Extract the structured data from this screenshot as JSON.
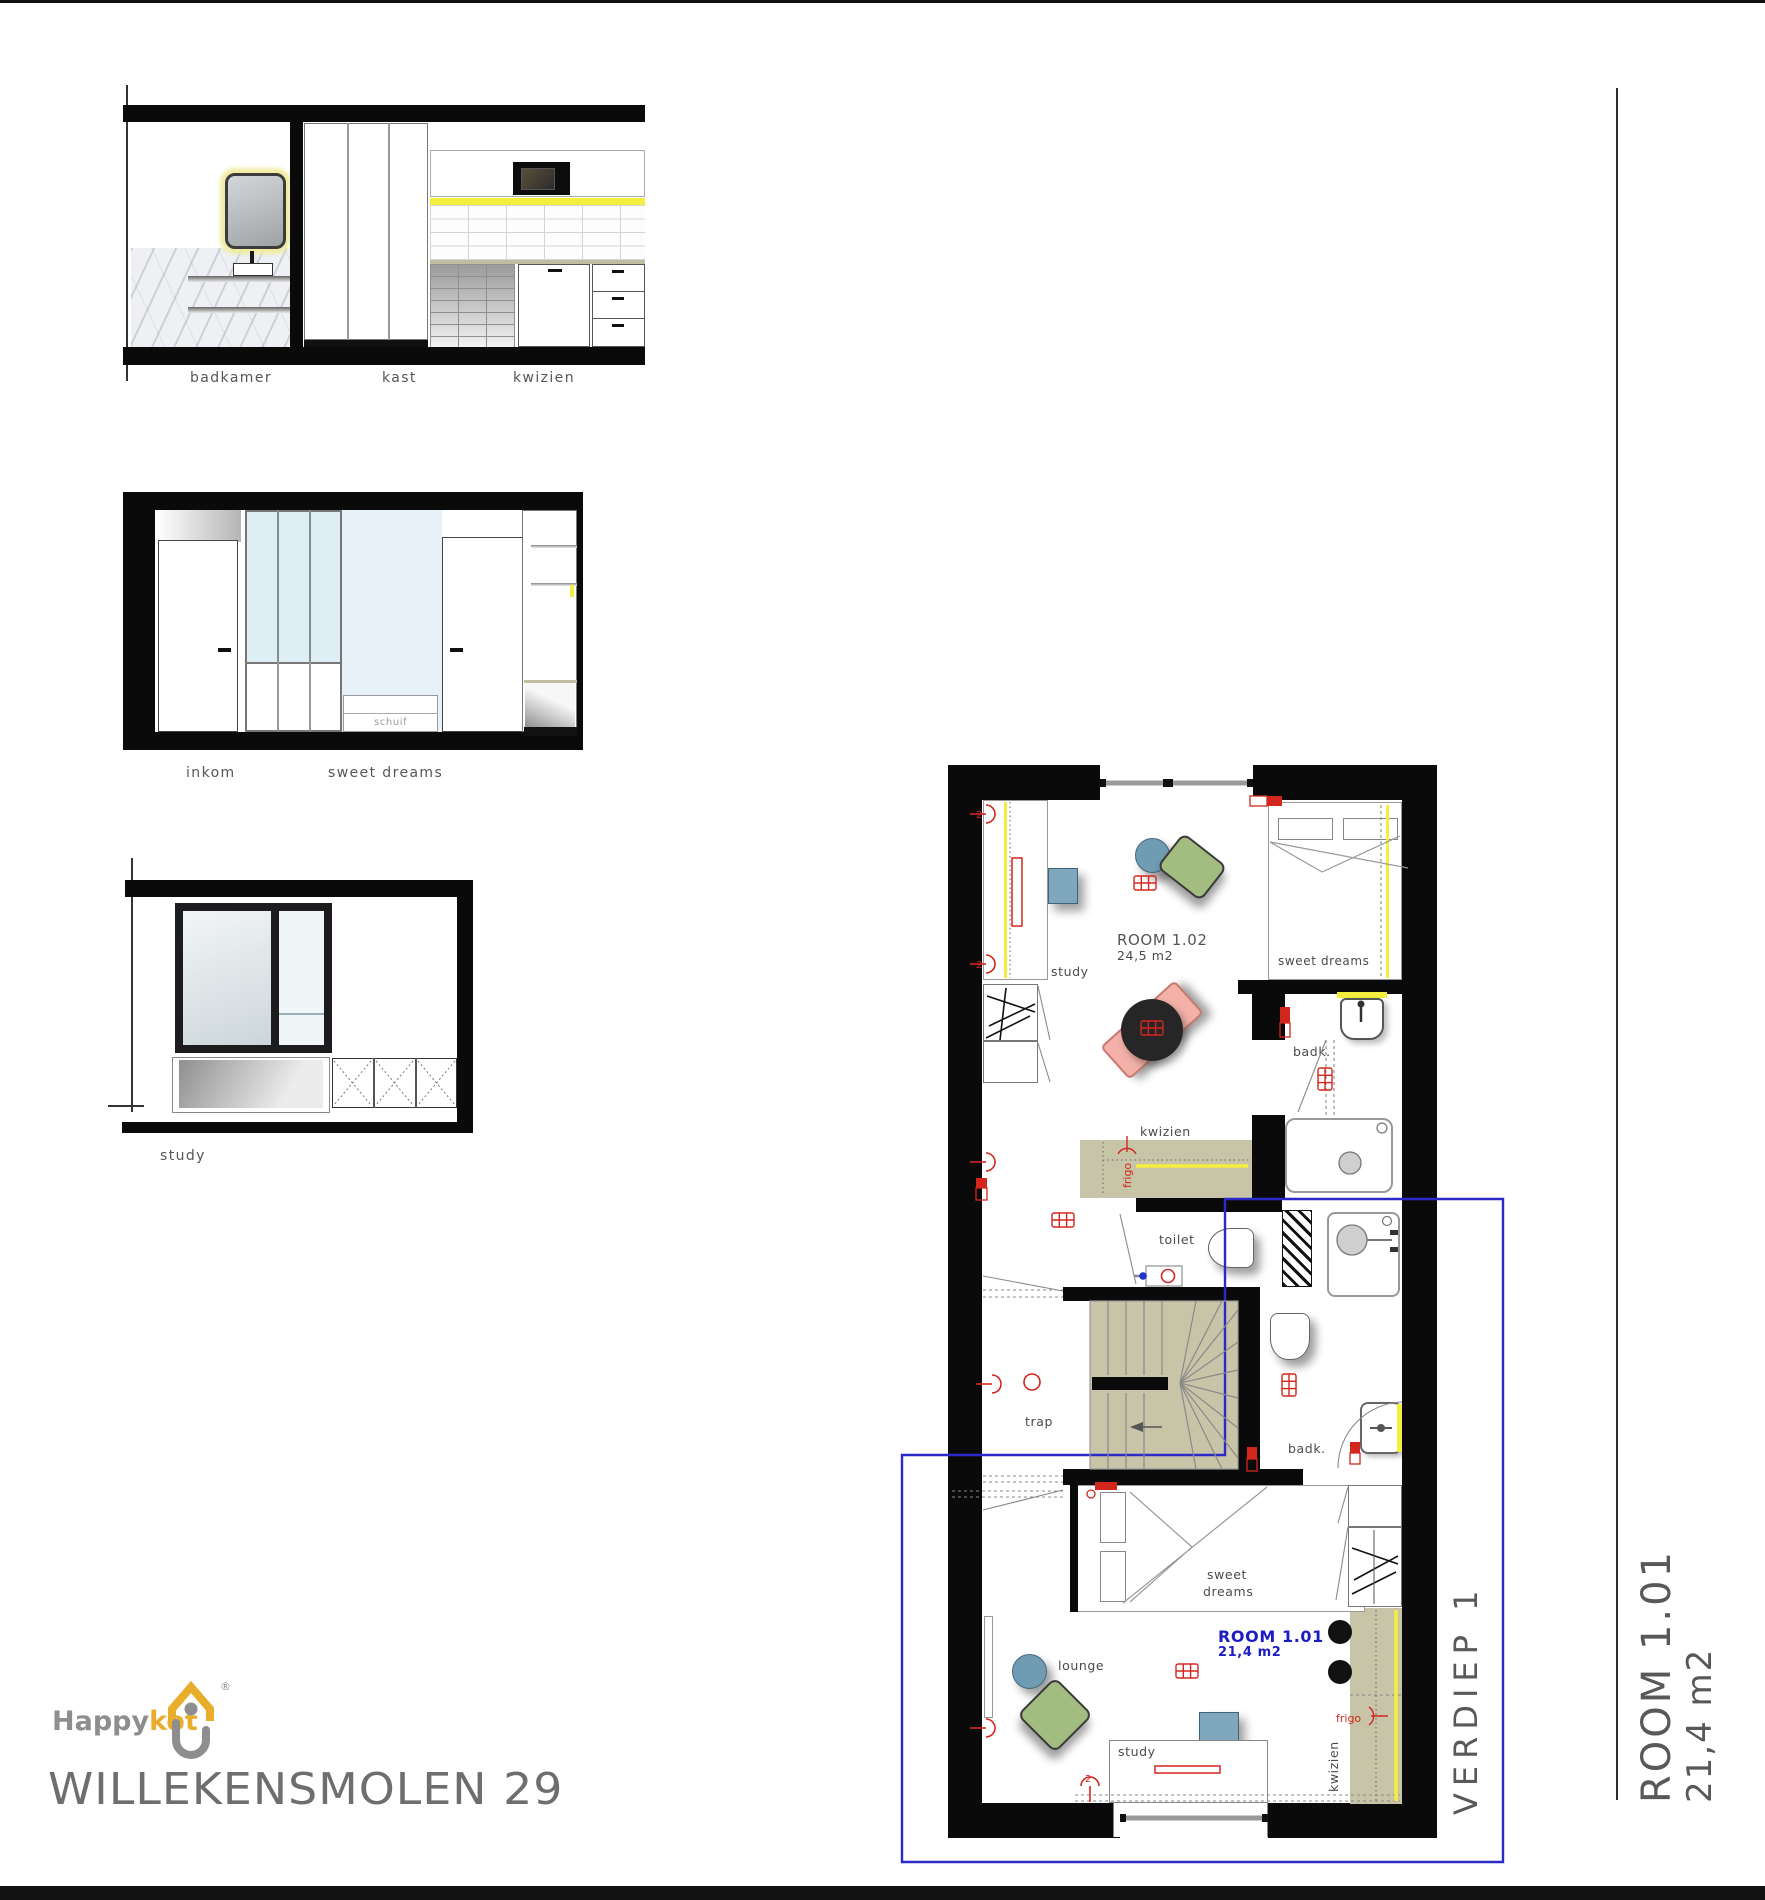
{
  "labels": {
    "badkamer": "badkamer",
    "kast": "kast",
    "kwizien": "kwizien",
    "inkom": "inkom",
    "sweet_dreams": "sweet dreams",
    "sweet": "sweet",
    "dreams": "dreams",
    "schuif": "schuif",
    "study": "study",
    "toilet": "toilet",
    "trap": "trap",
    "badk": "badk.",
    "lounge": "lounge",
    "frigo": "frigo",
    "room102": "ROOM 1.02",
    "room102_area": "24,5 m2",
    "room101": "ROOM 1.01",
    "room101_area": "21,4 m2",
    "verdiep": "VERDIEP 1"
  },
  "titleblock": {
    "room": "ROOM 1.01",
    "area": "21,4 m2"
  },
  "logo": {
    "happy": "Happy",
    "kot": "kot",
    "registered": "®",
    "address": "WILLEKENSMOLEN 29"
  },
  "colors": {
    "wall_black": "#0a0a0a",
    "counter_khaki": "#c8c4a8",
    "accent_yellow": "#f4ee3e",
    "room_outline_blue": "#2a2ac8",
    "room_text_blue": "#1c1cc4",
    "symbol_red": "#d3271d",
    "label_gray": "#4b4b4d",
    "title_gray": "#58585a",
    "logo_gray": "#8e8e90",
    "logo_yellow": "#e9ad2c",
    "glass_blue": "#e2f0f7",
    "chair_green": "#a3bc80",
    "chair_blue": "#7fa8bf",
    "lounge_pink": "#f3b1a9"
  }
}
